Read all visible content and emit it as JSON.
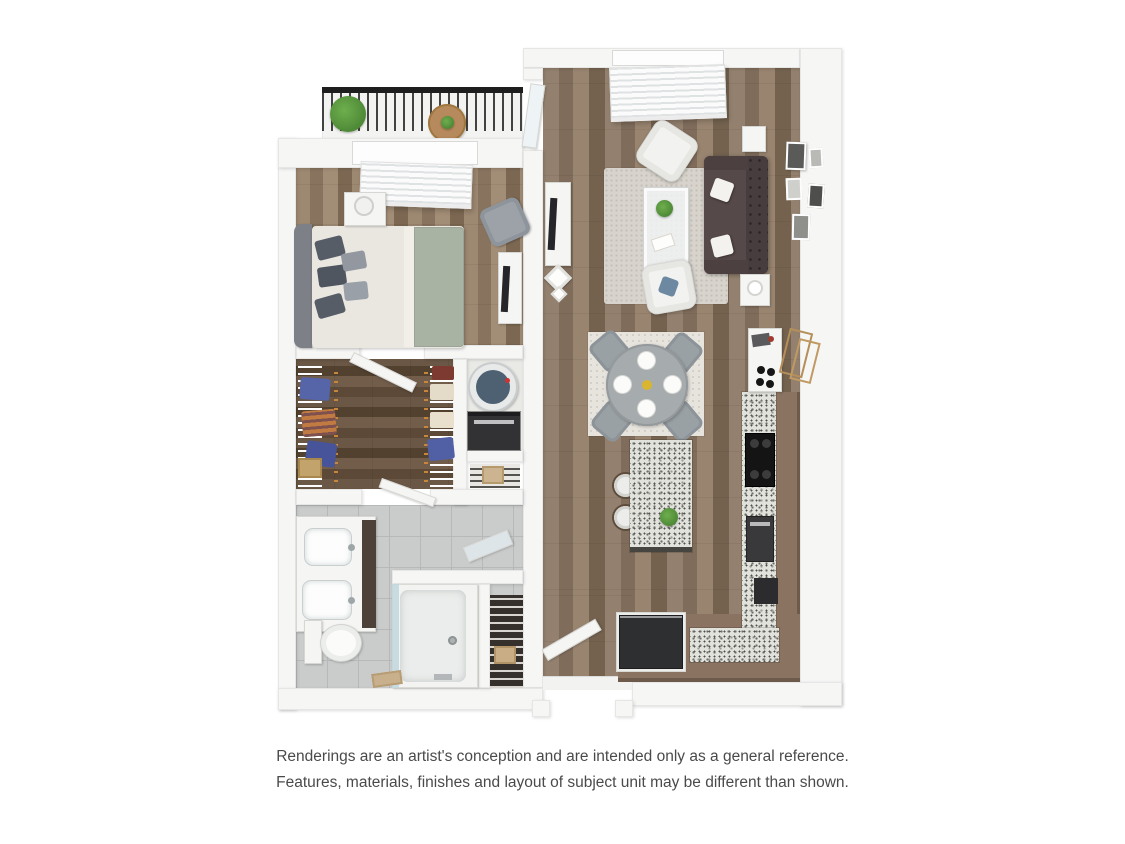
{
  "disclaimer": {
    "line1": "Renderings are an artist's conception and are intended only as a general reference.",
    "line2": "Features, materials, finishes and layout of subject unit may be different than shown."
  },
  "scene": {
    "type": "3d-floor-plan-rendering",
    "rooms": [
      "balcony",
      "bedroom",
      "walk-in-closet",
      "laundry-closet",
      "bathroom",
      "linen-closet",
      "entry",
      "living-room",
      "dining-area",
      "kitchen"
    ],
    "furnishings": [
      "balcony-plant",
      "balcony-table",
      "bed",
      "nightstand",
      "bedroom-armchair",
      "dresser-with-tv",
      "wire-closet-shelving",
      "water-heater",
      "stacked-washer-dryer",
      "double-sink-vanity",
      "toilet",
      "shower",
      "leaning-mirror",
      "sofa",
      "two-armchairs",
      "coffee-table",
      "tv-console",
      "area-rug",
      "wall-art",
      "bar-console",
      "dining-table-for-four",
      "kitchen-island-with-stools",
      "range",
      "refrigerator",
      "l-shaped-granite-counter"
    ]
  },
  "colors": {
    "background": "#ffffff",
    "wall": "#f6f6f5",
    "wood_floor": "#8b7767",
    "bedroom_wood": "#94806c",
    "closet_dark_wood": "#63503e",
    "tile_floor": "#cacccc",
    "granite_counter": "#e2e2dd",
    "cabinet_brown": "#8a7361",
    "sofa": "#554949",
    "sage_blanket": "#a9b3a4",
    "railing": "#1e1e1e",
    "plant_green": "#55963f",
    "gold_frame": "#b48f5a",
    "water_heater_blue": "#4d6173",
    "disclaimer_text": "#4a4a4a"
  }
}
